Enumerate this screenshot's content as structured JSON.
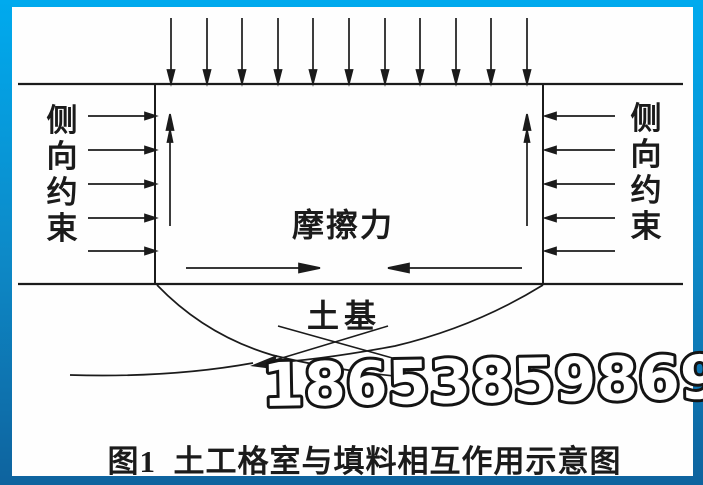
{
  "frame": {
    "gradient_top": "#00aaee",
    "gradient_middle": "#0d8ac8",
    "gradient_bottom": "#0e639e",
    "canvas_background": "#ffffff"
  },
  "diagram": {
    "line_color": "#1b1b1b",
    "labels": {
      "lateral_constraint_left": "侧向约束",
      "lateral_constraint_right": "侧向约束",
      "friction_force": "摩擦力",
      "subgrade": "土基"
    },
    "watermark": "18653859869",
    "caption": "图1  土工格室与填料相互作用示意图"
  }
}
